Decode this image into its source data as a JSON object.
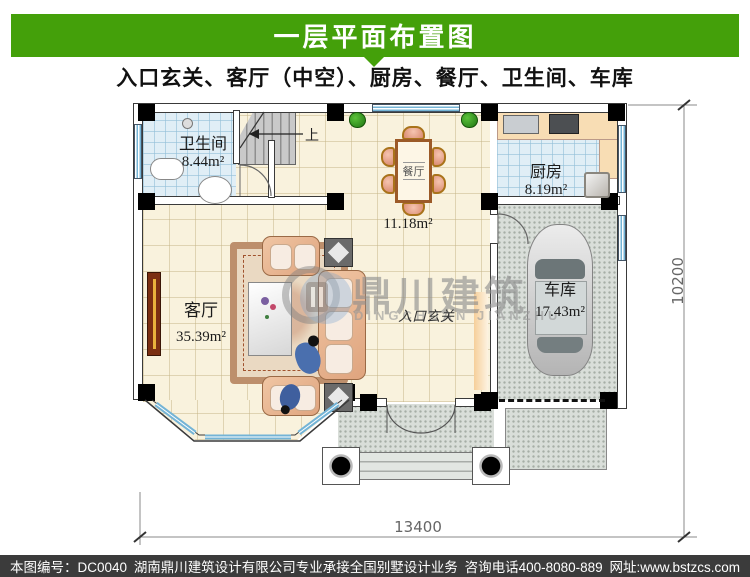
{
  "header": {
    "title": "一层平面布置图",
    "subtitle": "入口玄关、客厅（中空）、厨房、餐厅、卫生间、车库"
  },
  "rooms": {
    "bathroom": {
      "name": "卫生间",
      "area": "8.44m²"
    },
    "dining": {
      "name": "餐厅",
      "area": "11.18m²"
    },
    "kitchen": {
      "name": "厨房",
      "area": "8.19m²"
    },
    "living": {
      "name": "客厅",
      "area": "35.39m²"
    },
    "garage": {
      "name": "车库",
      "area": "17.43m²"
    },
    "entry": {
      "name": "入口玄关"
    }
  },
  "stairs": {
    "up_label": "上"
  },
  "dimensions": {
    "width_mm": "13400",
    "depth_mm": "10200"
  },
  "watermark": {
    "cn": "鼎川建筑",
    "en": "DINGCHUAN JIANZHU"
  },
  "footer": {
    "plan_no": "本图编号：DC0040",
    "company": "湖南鼎川建筑设计有限公司专业承接全国别墅设计业务",
    "phone": "咨询电话400-8080-889",
    "website": "网址:www.bstzcs.com"
  },
  "theme": {
    "banner_green": "#44a00a",
    "footer_bg": "#3b3b3b",
    "window_blue": "#74b4d6",
    "floor_cream": "#f9f2dd",
    "floor_tile_blue": "#e0eef6",
    "concrete_gray": "#d9ded9"
  }
}
